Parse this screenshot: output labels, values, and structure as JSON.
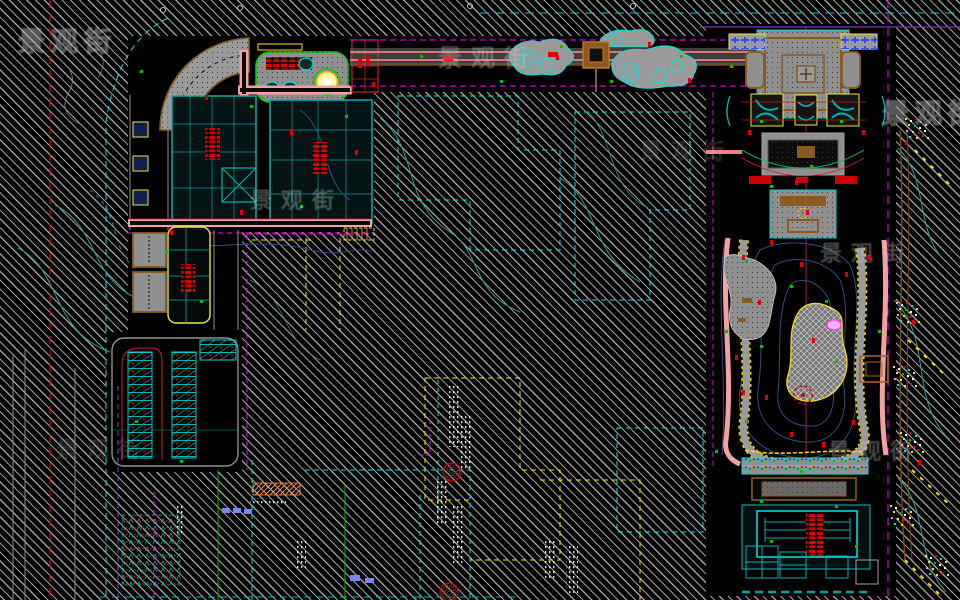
{
  "watermark": {
    "text": "景观街"
  },
  "palette": {
    "background": "#000000",
    "hatch_gray": "#9b9b9b",
    "cad_cyan": "#00e5e5",
    "cad_teal": "#00b0b0",
    "cad_yellow": "#ffe000",
    "cad_magenta": "#ff00ff",
    "road_salmon": "#f08080",
    "path_pink": "#f2a0a0",
    "timber_brown": "#8a5a20",
    "label_red": "#dd0000",
    "plant_green": "#00c000",
    "contour_green": "#2f9e8e",
    "water_blue": "#2e4f7f",
    "pave_gray": "#8f8f8f"
  }
}
